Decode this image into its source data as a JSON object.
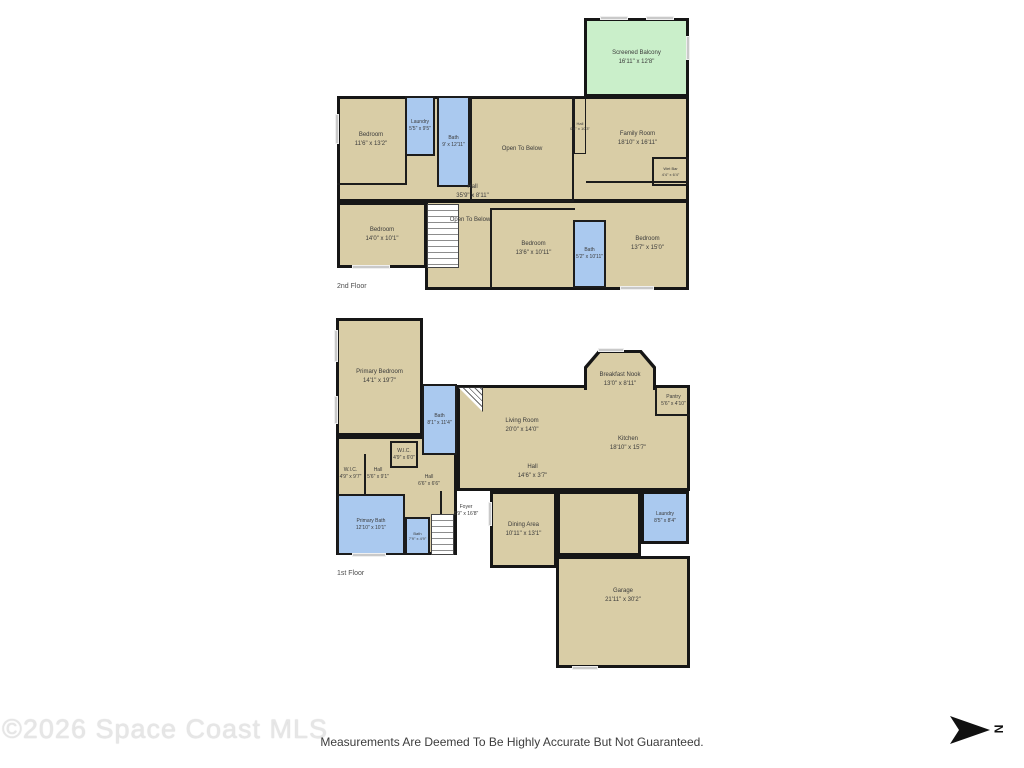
{
  "colors": {
    "floor_fill": "#d9cda6",
    "wet_room_fill": "#aac9ef",
    "balcony_fill": "#caefca",
    "wall": "#161616",
    "window": "#c9c9c9",
    "label_text": "#3b3b3b"
  },
  "floors": [
    {
      "name": "2nd Floor",
      "rooms": [
        {
          "label": "Screened Balcony",
          "dims": "16'11\" x 12'8\""
        },
        {
          "label": "Bedroom",
          "dims": "11'6\" x 13'2\""
        },
        {
          "label": "Laundry",
          "dims": "5'5\" x 9'5\""
        },
        {
          "label": "Bath",
          "dims": "9' x 12'11\""
        },
        {
          "label": "Open To Below",
          "dims": ""
        },
        {
          "label": "Hall",
          "dims": "0'8\" x 10'3\""
        },
        {
          "label": "Family Room",
          "dims": "18'10\" x 16'11\""
        },
        {
          "label": "Wet Bar",
          "dims": "4'4\" x 6'4\""
        },
        {
          "label": "Hall",
          "dims": "35'9\" x 8'11\""
        },
        {
          "label": "Open To Below",
          "dims": ""
        },
        {
          "label": "Bedroom",
          "dims": "14'0\" x 10'1\""
        },
        {
          "label": "Bedroom",
          "dims": "13'6\" x 10'11\""
        },
        {
          "label": "Bath",
          "dims": "5'2\" x 10'11\""
        },
        {
          "label": "Bedroom",
          "dims": "13'7\" x 15'0\""
        }
      ]
    },
    {
      "name": "1st Floor",
      "rooms": [
        {
          "label": "Primary Bedroom",
          "dims": "14'1\" x 19'7\""
        },
        {
          "label": "Bath",
          "dims": "8'1\" x 11'4\""
        },
        {
          "label": "Living Room",
          "dims": "20'0\" x 14'0\""
        },
        {
          "label": "Breakfast Nook",
          "dims": "13'0\" x 8'11\""
        },
        {
          "label": "Pantry",
          "dims": "5'6\" x 4'10\""
        },
        {
          "label": "Kitchen",
          "dims": "18'10\" x 15'7\""
        },
        {
          "label": "W.I.C.",
          "dims": "4'9\" x 9'7\""
        },
        {
          "label": "Hall",
          "dims": "5'6\" x 9'1\""
        },
        {
          "label": "W.I.C.",
          "dims": "4'9\" x 6'0\""
        },
        {
          "label": "Hall",
          "dims": "6'6\" x 6'6\""
        },
        {
          "label": "Foyer",
          "dims": "8'9\" x 16'8\""
        },
        {
          "label": "Primary Bath",
          "dims": "12'10\" x 10'1\""
        },
        {
          "label": "Bath",
          "dims": "7'9\" x 4'9\""
        },
        {
          "label": "Hall",
          "dims": "14'6\" x 3'7\""
        },
        {
          "label": "Dining Area",
          "dims": "10'11\" x 13'1\""
        },
        {
          "label": "Laundry",
          "dims": "8'5\" x 8'4\""
        },
        {
          "label": "Garage",
          "dims": "21'11\" x 30'2\""
        }
      ]
    }
  ],
  "footer": {
    "watermark": "©2026 Space Coast MLS",
    "disclaimer": "Measurements Are Deemed To Be Highly Accurate But Not Guaranteed.",
    "north_label": "N"
  }
}
